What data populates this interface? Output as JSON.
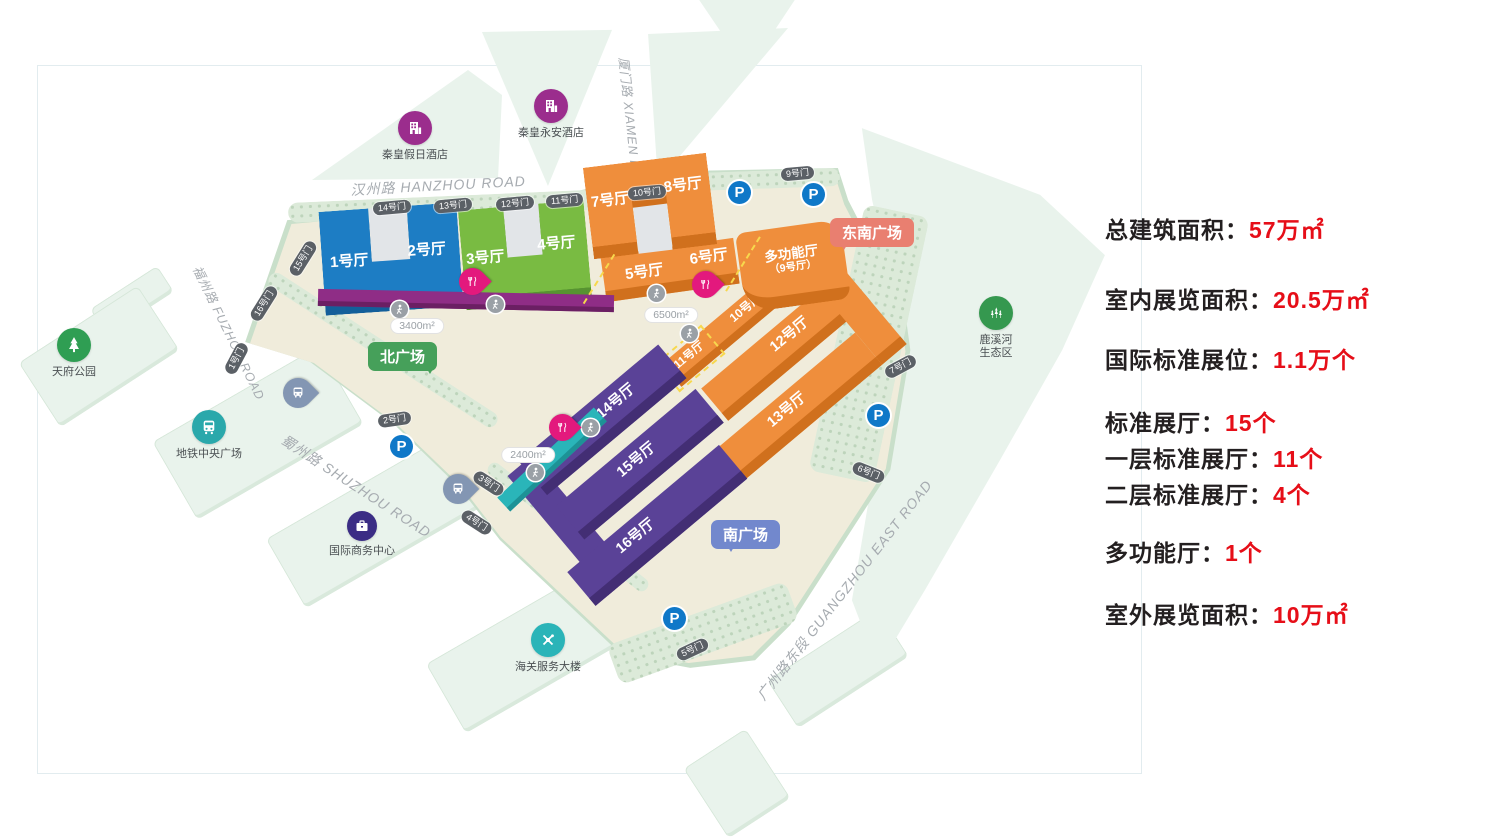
{
  "stats": {
    "items": [
      {
        "label": "总建筑面积：",
        "value": "57万㎡"
      },
      {
        "label": "室内展览面积：",
        "value": "20.5万㎡"
      },
      {
        "label": "国际标准展位：",
        "value": "1.1万个"
      },
      {
        "label": "标准展厅：",
        "value": "15个"
      },
      {
        "label": "一层标准展厅：",
        "value": "11个"
      },
      {
        "label": "二层标准展厅：",
        "value": "4个"
      },
      {
        "label": "多功能厅：",
        "value": "1个"
      },
      {
        "label": "室外展览面积：",
        "value": "10万㎡"
      }
    ]
  },
  "map": {
    "roads": {
      "hanzhou": "汉州路 HANZHOU ROAD",
      "xiamen": "厦门路 XIAMEN ROAD",
      "fuzhou": "福州路 FUZHOU ROAD",
      "shuzhou": "蜀州路 SHUZHOU ROAD",
      "guangzhou": "广州路东段 GUANGZHOU EAST ROAD"
    },
    "halls": {
      "h1": "1号厅",
      "h2": "2号厅",
      "h3": "3号厅",
      "h4": "4号厅",
      "h5": "5号厅",
      "h6": "6号厅",
      "h7": "7号厅",
      "h8": "8号厅",
      "h10": "10号厅",
      "h11": "11号厅",
      "h12": "12号厅",
      "h13": "13号厅",
      "h14": "14号厅",
      "h15": "15号厅",
      "h16": "16号厅",
      "multi": "多功能厅",
      "multi_sub": "（9号厅）"
    },
    "gates": [
      "1号门",
      "2号门",
      "3号门",
      "4号门",
      "5号门",
      "6号门",
      "7号门",
      "9号门",
      "10号门",
      "11号门",
      "12号门",
      "13号门",
      "14号门",
      "15号门",
      "16号门"
    ],
    "plazas": {
      "north": "北广场",
      "south": "南广场",
      "southeast": "东南广场"
    },
    "areas": [
      "3400m²",
      "6500m²",
      "2400m²"
    ],
    "landmarks": [
      {
        "id": "hotel-holiday",
        "label": "秦皇假日酒店"
      },
      {
        "id": "hotel-yongan",
        "label": "秦皇永安酒店"
      },
      {
        "id": "tianfu-park",
        "label": "天府公园"
      },
      {
        "id": "metro-plaza",
        "label": "地铁中央广场"
      },
      {
        "id": "intl-business-center",
        "label": "国际商务中心"
      },
      {
        "id": "customs-building",
        "label": "海关服务大楼"
      },
      {
        "id": "luxi-river",
        "label": "鹿溪河",
        "label2": "生态区"
      }
    ],
    "parking_label": "P"
  },
  "colors": {
    "hall_blue": "#1d7dc4",
    "hall_green": "#79bb42",
    "hall_orange": "#ef8e3c",
    "hall_purple": "#5a4297",
    "strip_magenta": "#8f2d86",
    "strip_teal": "#2ab5b9",
    "stat_red": "#e60e18",
    "plaza_north": "#46a05a",
    "plaza_south": "#7288cd",
    "plaza_southeast": "#e97f70",
    "parking_blue": "#0f78c8"
  }
}
